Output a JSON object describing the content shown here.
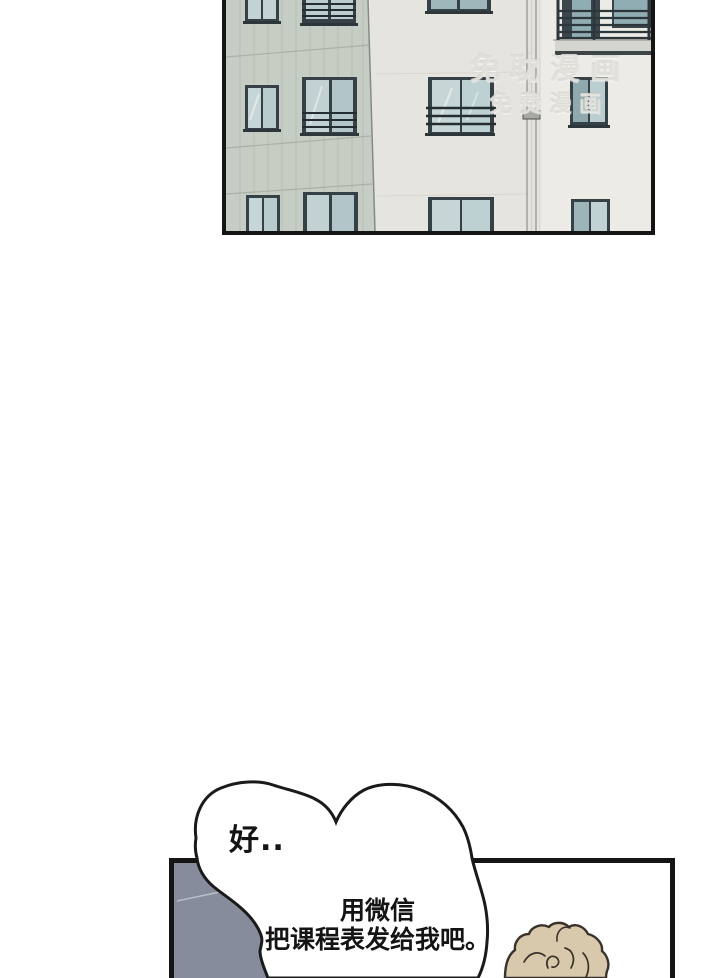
{
  "page": {
    "width": 720,
    "height": 978,
    "background": "#ffffff"
  },
  "watermark": {
    "line1": "免耽漫画",
    "line2": "免费漫画"
  },
  "speech_bubble": {
    "ok": "好..",
    "wechat_line1": "用微信",
    "wechat_line2": "把课程表发给我吧。"
  },
  "colors": {
    "panel_border": "#151515",
    "bubble_outline": "#1a1a1a",
    "wall_sage": "#c5cdc4",
    "wall_mid": "#e6e4df",
    "wall_right": "#ecebe6",
    "window_frame": "#364147",
    "window_glass": "#c4d3d3",
    "gray_wall": "#868c9c",
    "hair": "#d8c8ac",
    "text": "#141414"
  }
}
